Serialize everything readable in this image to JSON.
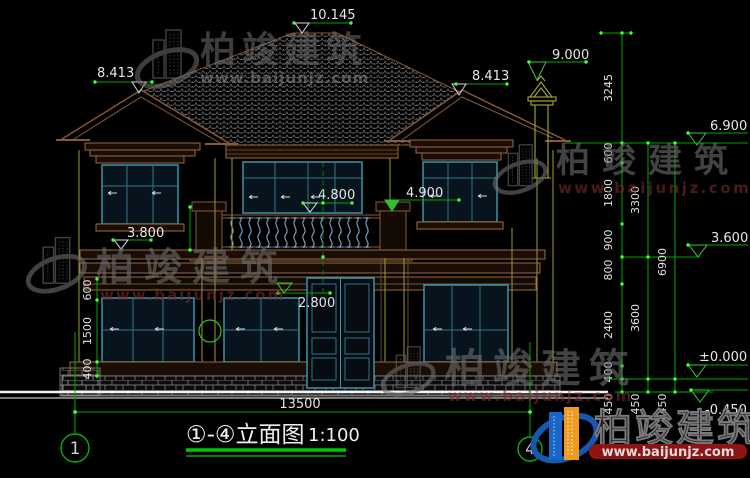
{
  "watermarks": {
    "brand": "柏竣建筑",
    "site": "www.baijunjz.com"
  },
  "elevation_markers": {
    "ridge": "10.145",
    "left_gable": "8.413",
    "right_gable": "8.413",
    "chimney": "9.000",
    "eave": "6.900",
    "balcony": "4.800",
    "balcony_post": "4.900",
    "left_band": "3.800",
    "right_band": "3.600",
    "door_head": "2.800",
    "ground": "±0.000",
    "site_level": "-0.450"
  },
  "dimensions": {
    "overall_width": "13500",
    "right_chain_top": "3245",
    "right_chain_inner": [
      "600",
      "1800",
      "900",
      "800",
      "2400",
      "400",
      "450"
    ],
    "right_chain_middle": [
      "3300",
      "3600",
      "450"
    ],
    "right_chain_outer": [
      "6900",
      "450"
    ],
    "left_chain": [
      "600",
      "1500",
      "400"
    ]
  },
  "axis_bubbles": {
    "left": "1",
    "right": "4"
  },
  "title_block": {
    "title": "①-④立面图",
    "scale": "1:100"
  },
  "logo": {
    "brand": "柏竣建筑",
    "site": "www.baijunjz.com"
  }
}
